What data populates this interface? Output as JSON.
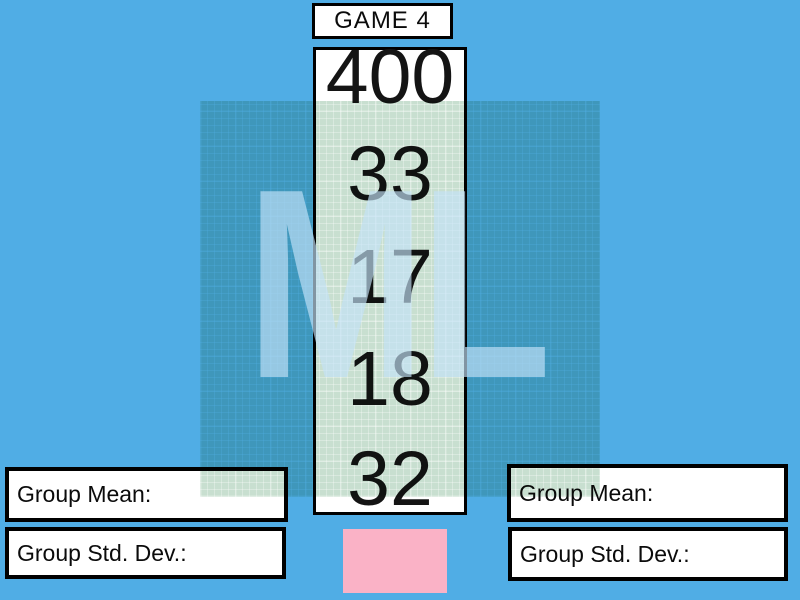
{
  "header": {
    "title": "GAME 4"
  },
  "board": {
    "values": [
      "400",
      "33",
      "17",
      "18",
      "32"
    ]
  },
  "watermark": {
    "text": "ML"
  },
  "panels": {
    "left": {
      "mean": "Group Mean:",
      "std": "Group Std. Dev.:"
    },
    "right": {
      "mean": "Group Mean:",
      "std": "Group Std. Dev.:"
    }
  },
  "colors": {
    "background_blue": "#50ADE5",
    "square_green_tint": "#C8DFD0",
    "square_over_background": "#3F9DAA",
    "watermark_light_blue": "#87C5EC",
    "pink_card": "#FAB2C6",
    "box_fill": "#FFFFFF",
    "box_border": "#000000",
    "number_text": "#141414"
  }
}
